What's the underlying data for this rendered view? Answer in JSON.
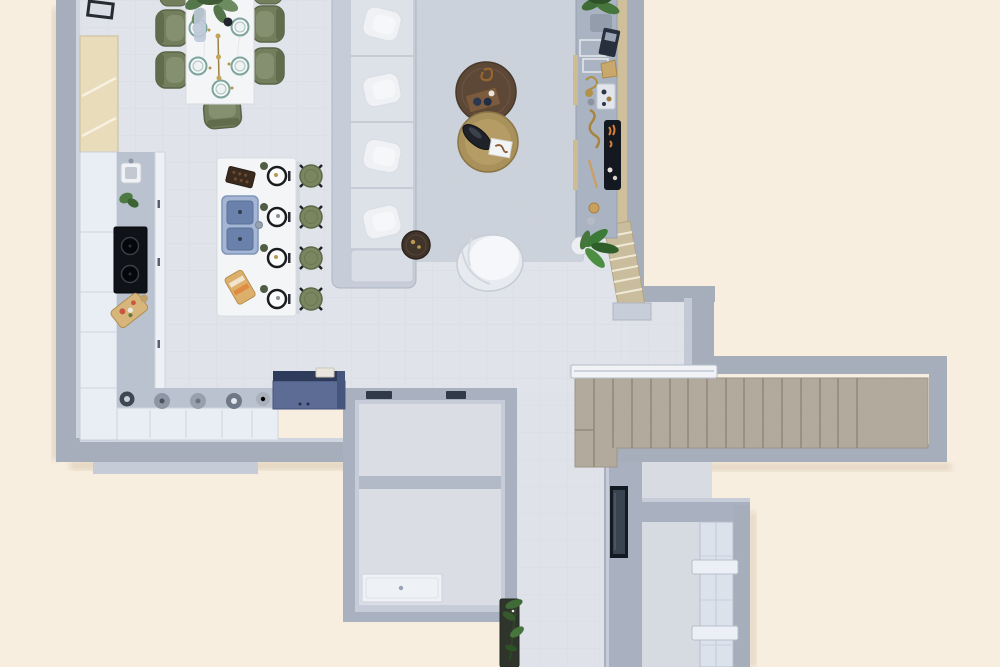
{
  "meta": {
    "description": "Top-down 3D rendered floor plan of an open-plan apartment with kitchen, dining area, living room, staircase, bathroom and hallway",
    "view": "top-down architectural render",
    "canvas": {
      "width": 1000,
      "height": 667
    }
  },
  "palette": {
    "background_cream": "#f7eee0",
    "floor": "#e0e3e9",
    "rug": "#ced4dd",
    "wall": "#a6aebc",
    "wall_inner_light": "#c6cdd9",
    "stairs_carpet": "#b3aa9d",
    "entry_steps_wood": "#c9bd9e",
    "olive_green_chairs": "#737f5c",
    "plant_green": "#47763c",
    "brass": "#a9915b",
    "walnut": "#5d4736",
    "sink_blue": "#6a82ab",
    "appliance_navy": "#5c6c94",
    "cooktop_black": "#0f1217",
    "white_furniture": "#f3f5f7"
  },
  "rooms": [
    {
      "id": "kitchen",
      "label": "Kitchen with L-shaped counter and island"
    },
    {
      "id": "dining",
      "label": "Dining area"
    },
    {
      "id": "living",
      "label": "Living room"
    },
    {
      "id": "hallway",
      "label": "Hallway"
    },
    {
      "id": "bathroom",
      "label": "Bathroom with shower tray"
    },
    {
      "id": "storage",
      "label": "Storage room"
    },
    {
      "id": "entry",
      "label": "Entry hall with built-in wardrobe"
    },
    {
      "id": "stairs",
      "label": "Staircase zone"
    }
  ],
  "furniture": {
    "dining_table": {
      "label": "White marble dining table with plant centerpiece, candlesticks and five place settings",
      "place_settings": 5
    },
    "dining_chairs": {
      "label": "Olive green dining chairs",
      "count": 7
    },
    "wall_art": {
      "label": "Framed artwork against wall"
    },
    "pantry_cabinet": {
      "label": "Tall wooden pantry cabinet"
    },
    "kitchen_counter": {
      "label": "L-shaped kitchen counter with prep sink, herb plant, cooktop, cutting board and cookware"
    },
    "cooktop": {
      "label": "Black cooktop with two burners"
    },
    "island": {
      "label": "Kitchen island with double sink, chocolate tray, sandwich board and four place settings",
      "place_settings": 4
    },
    "bar_stools": {
      "label": "Olive bar stools with black cross legs",
      "count": 4
    },
    "blue_cabinet": {
      "label": "Dark blue sideboard cabinet with tray"
    },
    "sofa": {
      "label": "Light gray sectional sofa with four pillowed seats and end chaise",
      "seats": 5
    },
    "rug": {
      "label": "Light gray area rug"
    },
    "coffee_table_walnut": {
      "label": "Round walnut coffee table with wooden tray and brass ornament"
    },
    "coffee_table_brass": {
      "label": "Round brass coffee table with black vase and white book"
    },
    "side_table": {
      "label": "Small round dark side table with gold decor"
    },
    "lounge_chair": {
      "label": "White round swivel lounge chair"
    },
    "media_console": {
      "label": "Wall console with trays, tablet, sculptures, bowls and recessed fireplace"
    },
    "fireplace": {
      "label": "Recessed fireplace with flames"
    },
    "stairs_main": {
      "label": "Carpeted main staircase with landing",
      "treads": 16
    },
    "stairs_entry": {
      "label": "Angled wooden entry steps",
      "treads": 7
    },
    "railing": {
      "label": "White stair railing"
    },
    "shower": {
      "label": "White shower tray with drain"
    },
    "mirror": {
      "label": "Tall dark wall mirror"
    },
    "wardrobe": {
      "label": "Built-in wardrobe panels with shelves"
    },
    "plants": {
      "label": "Potted green plants",
      "count": 4
    },
    "wall_vents": {
      "label": "Dark wall vents on bathroom block"
    }
  }
}
